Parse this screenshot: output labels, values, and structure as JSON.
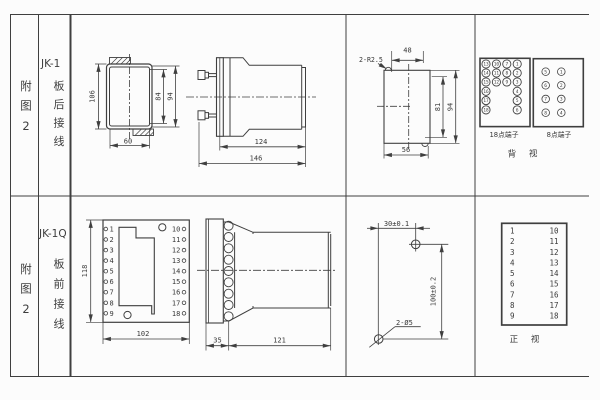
{
  "page": {
    "background": "#fcfcfc",
    "line_color": "#3f3f3f"
  },
  "row1": {
    "figure_label": "附图2",
    "model": "JK-1",
    "wiring_label": "板后接线",
    "panel_view": {
      "dim_height": "106",
      "dim_inner_height": "84",
      "dim_outer_height": "94",
      "dim_width": "60"
    },
    "side_view": {
      "dim_depth": "124",
      "dim_total_depth": "146"
    },
    "cutout_view": {
      "note": "2-R2.5",
      "dim_top_width": "48",
      "dim_inner_height": "81",
      "dim_height": "94",
      "dim_bottom_width": "56"
    },
    "rear_view": {
      "caption": "背 视",
      "block18": {
        "label": "18点端子",
        "grid": [
          [
            "13",
            "10",
            "7",
            "1"
          ],
          [
            "14",
            "11",
            "8",
            "2"
          ],
          [
            "15",
            "12",
            "9",
            "3"
          ],
          [
            "16",
            null,
            null,
            "4"
          ],
          [
            "17",
            null,
            null,
            "5"
          ],
          [
            "18",
            null,
            null,
            "6"
          ]
        ]
      },
      "block8": {
        "label": "8点端子",
        "grid": [
          [
            "5",
            "1"
          ],
          [
            "6",
            "2"
          ],
          [
            "7",
            "3"
          ],
          [
            "8",
            "4"
          ]
        ]
      }
    }
  },
  "row2": {
    "figure_label": "附图2",
    "model": "JK-1Q",
    "wiring_label": "板前接线",
    "panel_view": {
      "dim_height": "118",
      "dim_width": "102",
      "left_terminals": [
        "1",
        "2",
        "3",
        "4",
        "5",
        "6",
        "7",
        "8",
        "9"
      ],
      "right_terminals": [
        "10",
        "11",
        "12",
        "13",
        "14",
        "15",
        "16",
        "17",
        "18"
      ]
    },
    "side_view": {
      "dim_front": "35",
      "dim_depth": "121"
    },
    "drill_plan": {
      "dim_horizontal": "30±0.1",
      "dim_vertical": "100±0.2",
      "note": "2-Ø5"
    },
    "front_table": {
      "caption": "正 视",
      "left": [
        "1",
        "2",
        "3",
        "4",
        "5",
        "6",
        "7",
        "8",
        "9"
      ],
      "right": [
        "10",
        "11",
        "12",
        "13",
        "14",
        "15",
        "16",
        "17",
        "18"
      ]
    }
  }
}
